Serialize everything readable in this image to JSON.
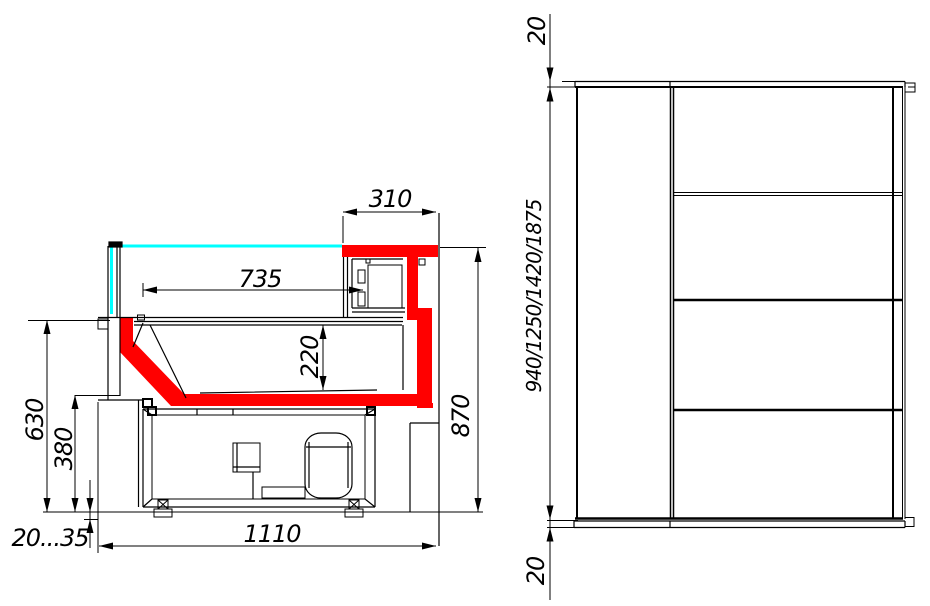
{
  "drawing": {
    "side_section": {
      "dim_top_shelf_width": "310",
      "dim_display_width": "735",
      "dim_basin_depth": "220",
      "dim_counter_height": "630",
      "dim_front_panel_height": "380",
      "dim_overall_height": "870",
      "dim_base_width": "1110",
      "dim_foot_range": "20...35"
    },
    "front_elevation": {
      "dim_top_thickness": "20",
      "dim_heights": "940/1250/1420/1875",
      "dim_bottom_thickness": "20"
    },
    "colors": {
      "highlight_red": "#ff0000",
      "glass_cyan": "#00ffff",
      "line_black": "#000000",
      "background": "#ffffff"
    }
  }
}
